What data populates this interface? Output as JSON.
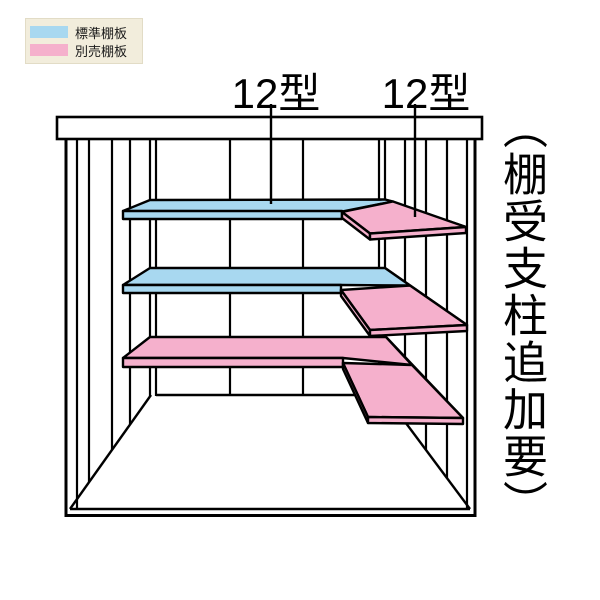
{
  "legend": {
    "items": [
      {
        "label": "標準棚板",
        "color": "#a8d8f0"
      },
      {
        "label": "別売棚板",
        "color": "#f5b0cc"
      }
    ]
  },
  "labels": {
    "shelf_left": "12型",
    "shelf_right": "12型"
  },
  "side_note": "（棚受支柱追加要）",
  "colors": {
    "standard_shelf": "#a8d8f0",
    "optional_shelf": "#f5b0cc",
    "line": "#000000",
    "legend_bg": "#f2eddc"
  }
}
